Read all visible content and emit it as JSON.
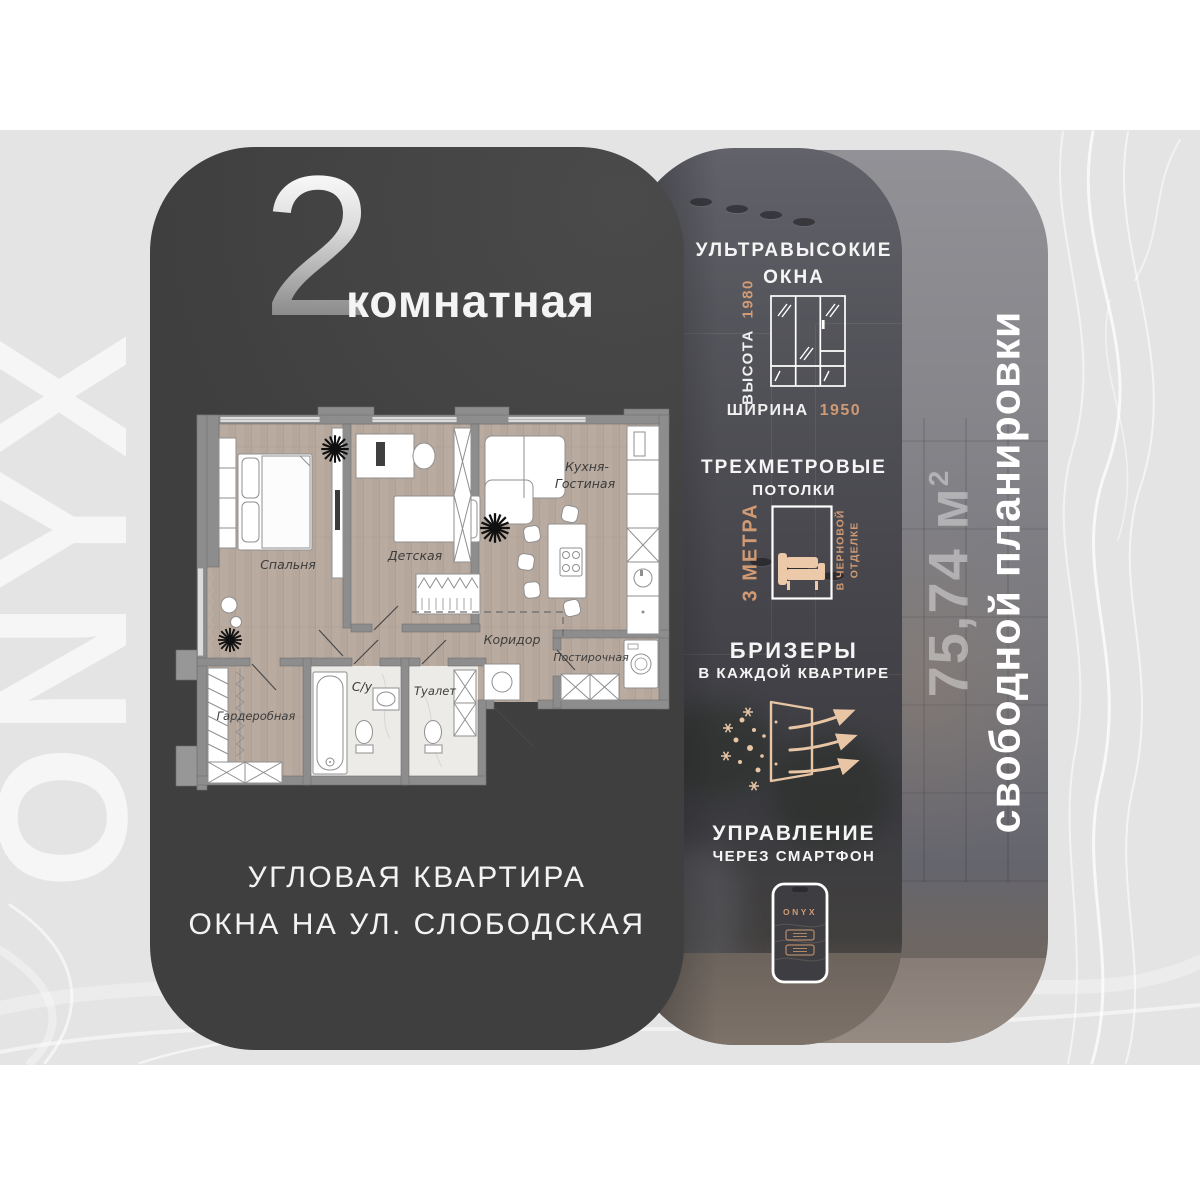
{
  "watermark": "ONYX",
  "accent_color": "#cf9a74",
  "plan_card": {
    "rooms_count": "2",
    "rooms_word": "комнатная",
    "footer_line1": "УГЛОВАЯ КВАРТИРА",
    "footer_line2": "ОКНА НА УЛ. СЛОБОДСКАЯ"
  },
  "floorplan": {
    "bedroom": "Спальня",
    "kids_room": "Детская",
    "kitchen_line1": "Кухня-",
    "kitchen_line2": "Гостиная",
    "corridor": "Коридор",
    "laundry": "Постирочная",
    "wardrobe": "Гардеробная",
    "bathroom": "С/у",
    "toilet": "Туалет"
  },
  "features": {
    "windows": {
      "title_line1": "УЛЬТРАВЫСОКИЕ",
      "title_line2": "ОКНА",
      "height_label": "ВЫСОТА",
      "height_value": "1980",
      "width_label": "ШИРИНА",
      "width_value": "1950"
    },
    "ceilings": {
      "title_line1": "ТРЕХМЕТРОВЫЕ",
      "title_line2": "ПОТОЛКИ",
      "height_label": "3 МЕТРА",
      "note_line1": "В ЧЕРНОВОЙ",
      "note_line2": "ОТДЕЛКЕ"
    },
    "breezers": {
      "title_line1": "БРИЗЕРЫ",
      "title_line2": "В КАЖДОЙ КВАРТИРЕ"
    },
    "smart_control": {
      "title_line1": "УПРАВЛЕНИЕ",
      "title_line2": "ЧЕРЕЗ СМАРТФОН",
      "phone_brand": "ONYX"
    }
  },
  "area_panel": {
    "area_value": "75,74 м",
    "area_sup": "2",
    "subtitle": "свободной планировки"
  }
}
